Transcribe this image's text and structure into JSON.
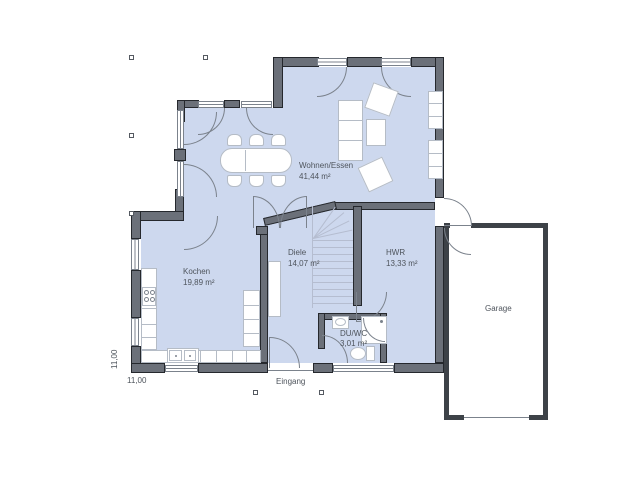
{
  "rooms": {
    "wohnen": {
      "name": "Wohnen/Essen",
      "area": "41,44 m²"
    },
    "kochen": {
      "name": "Kochen",
      "area": "19,89 m²"
    },
    "diele": {
      "name": "Diele",
      "area": "14,07 m²"
    },
    "hwr": {
      "name": "HWR",
      "area": "13,33 m²"
    },
    "duwc": {
      "name": "DU/WC",
      "area": "3,01 m²"
    },
    "garage": {
      "name": "Garage"
    }
  },
  "labels": {
    "entrance": "Eingang",
    "dim_left": "11,00",
    "dim_bottom": "11,00"
  },
  "colors": {
    "floor": "#cdd8ee",
    "wall": "#6b7079",
    "wall_outline": "#25282d",
    "garage_wall": "#3d4248",
    "line": "#7b828c",
    "furniture_border": "#b5bcc6",
    "stair_line": "#b5bdd0",
    "text": "#4e545c",
    "marker": "#555a61"
  }
}
